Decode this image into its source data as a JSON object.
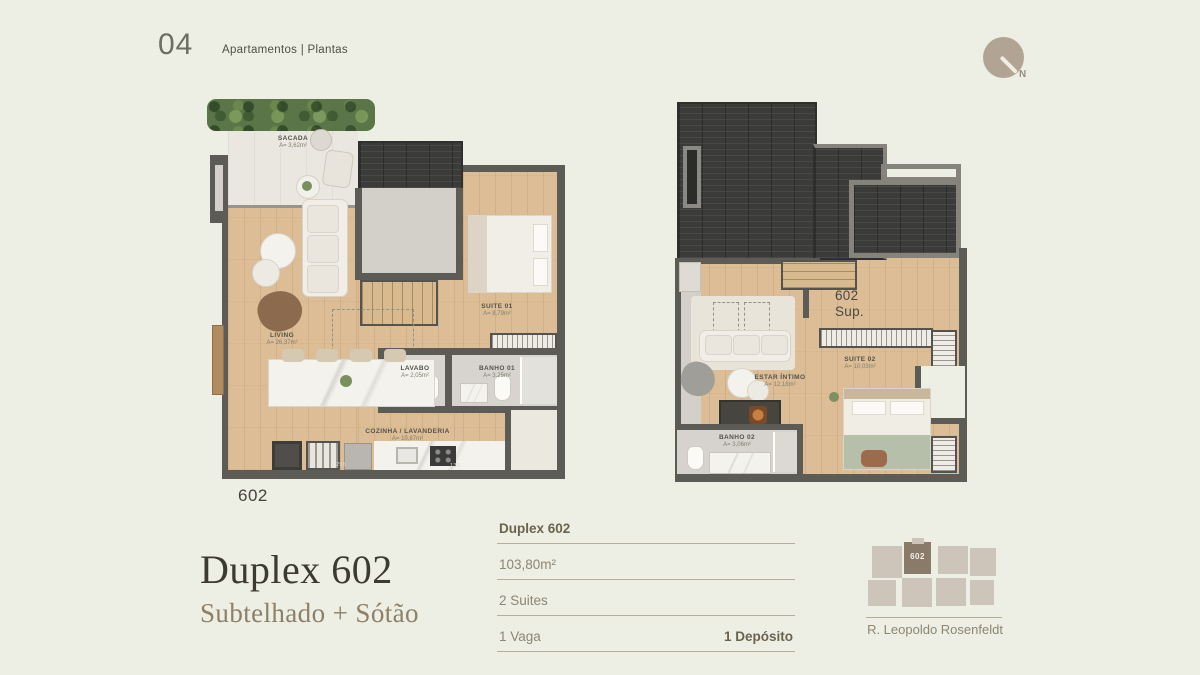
{
  "page": {
    "background": "#edeee4"
  },
  "header": {
    "page_number": "04",
    "breadcrumb": "Apartamentos | Plantas"
  },
  "compass": {
    "north_label": "N"
  },
  "floor_plans": {
    "lower": {
      "unit_label": "602",
      "rooms": {
        "sacada": {
          "name": "SACADA",
          "area": "A= 3,62m²"
        },
        "living": {
          "name": "LIVING",
          "area": "A= 26,37m²"
        },
        "suite01": {
          "name": "SUITE 01",
          "area": "A= 8,79m²"
        },
        "lavabo": {
          "name": "LAVABO",
          "area": "A= 2,05m²"
        },
        "banho01": {
          "name": "BANHO 01",
          "area": "A= 3,25m²"
        },
        "cozinha": {
          "name": "COZINHA / LAVANDERIA",
          "area": "A= 10,87m²"
        }
      },
      "dimensions": {
        "kitchen_left": "295",
        "kitchen_right": "130"
      }
    },
    "upper": {
      "unit_label_line1": "602",
      "unit_label_line2": "Sup.",
      "rooms": {
        "estar": {
          "name": "ESTAR ÍNTIMO",
          "area": "A= 12,18m²"
        },
        "suite02": {
          "name": "SUITE 02",
          "area": "A= 10,03m²"
        },
        "banho02": {
          "name": "BANHO 02",
          "area": "A= 3,06m²"
        }
      }
    }
  },
  "title_block": {
    "title": "Duplex 602",
    "subtitle": "Subtelhado + Sótão"
  },
  "specs": {
    "unit": "Duplex 602",
    "area": "103,80m²",
    "suites": "2 Suites",
    "parking": "1 Vaga",
    "deposit": "1 Depósito"
  },
  "keyplan": {
    "highlighted_unit": "602",
    "street": "R. Leopoldo Rosenfeldt"
  },
  "colors": {
    "wall": "#5d5b55",
    "taupe": "#b1a494",
    "text_dark": "#3c3a31",
    "text_muted": "#8c8673",
    "keyplan_highlight": "#897a69"
  }
}
